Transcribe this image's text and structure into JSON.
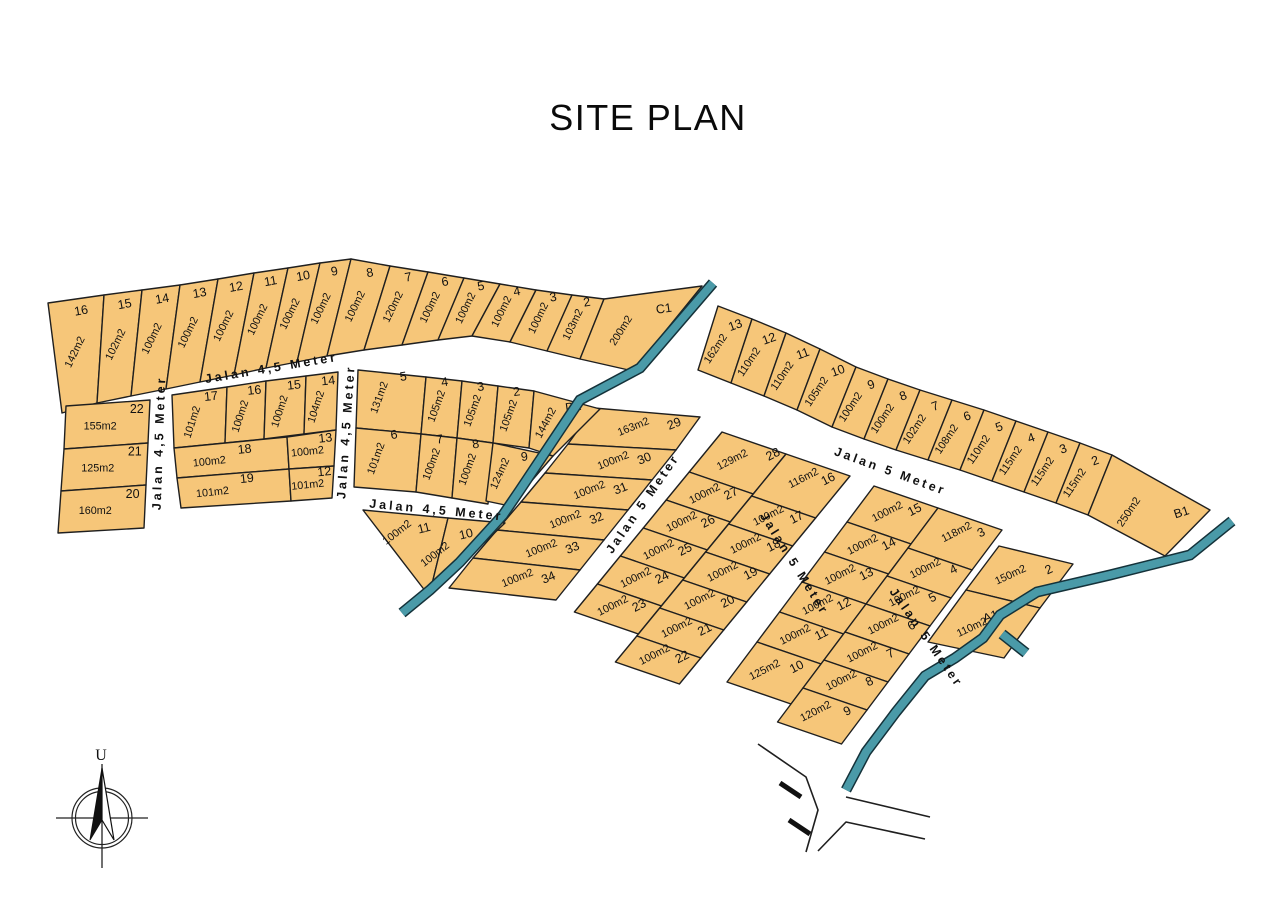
{
  "title": "SITE PLAN",
  "compass": {
    "north_label": "U"
  },
  "palette": {
    "lot_fill": "#F6C679",
    "lot_stroke": "#1F1F1F",
    "water": "#4A9AA8",
    "ink": "#111111"
  },
  "roads": {
    "top_45": "Jalan 4,5 Meter",
    "west_45": "Jalan 4,5 Meter",
    "mid_45": "Jalan 4,5 Meter",
    "lower_45": "Jalan 4,5 Meter",
    "d1_east_5": "Jalan 5 Meter",
    "mid_5": "Jalan 5 Meter",
    "northeast_5": "Jalan 5 Meter",
    "southeast_5": "Jalan 5 Meter"
  },
  "blocks": {
    "strip_top": {
      "lots": [
        {
          "no": "16",
          "size": "142m2"
        },
        {
          "no": "15",
          "size": "102m2"
        },
        {
          "no": "14",
          "size": "100m2"
        },
        {
          "no": "13",
          "size": "100m2"
        },
        {
          "no": "12",
          "size": "100m2"
        },
        {
          "no": "11",
          "size": "100m2"
        },
        {
          "no": "10",
          "size": "100m2"
        },
        {
          "no": "9",
          "size": "100m2"
        },
        {
          "no": "8",
          "size": "100m2"
        },
        {
          "no": "7",
          "size": "120m2"
        },
        {
          "no": "6",
          "size": "100m2"
        },
        {
          "no": "5",
          "size": "100m2"
        },
        {
          "no": "4",
          "size": "100m2"
        },
        {
          "no": "3",
          "size": "100m2"
        },
        {
          "no": "2",
          "size": "103m2"
        },
        {
          "no": "C1",
          "size": "200m2"
        }
      ]
    },
    "strip_right": {
      "lots": [
        {
          "no": "13",
          "size": "162m2"
        },
        {
          "no": "12",
          "size": "110m2"
        },
        {
          "no": "11",
          "size": "110m2"
        },
        {
          "no": "10",
          "size": "105m2"
        },
        {
          "no": "9",
          "size": "100m2"
        },
        {
          "no": "8",
          "size": "100m2"
        },
        {
          "no": "7",
          "size": "102m2"
        },
        {
          "no": "6",
          "size": "108m2"
        },
        {
          "no": "5",
          "size": "110m2"
        },
        {
          "no": "4",
          "size": "115m2"
        },
        {
          "no": "3",
          "size": "115m2"
        },
        {
          "no": "2",
          "size": "115m2"
        },
        {
          "no": "B1",
          "size": "250m2"
        }
      ]
    },
    "block_left": {
      "lots": [
        {
          "no": "22",
          "size": "155m2"
        },
        {
          "no": "21",
          "size": "125m2"
        },
        {
          "no": "20",
          "size": "160m2"
        }
      ]
    },
    "block_midwest": {
      "lots": [
        {
          "no": "17",
          "size": "101m2"
        },
        {
          "no": "16",
          "size": "100m2"
        },
        {
          "no": "15",
          "size": "100m2"
        },
        {
          "no": "14",
          "size": "104m2"
        },
        {
          "no": "18",
          "size": "100m2"
        },
        {
          "no": "13",
          "size": "100m2"
        },
        {
          "no": "19",
          "size": "101m2"
        },
        {
          "no": "12",
          "size": "101m2"
        }
      ]
    },
    "block_d1": {
      "lots": [
        {
          "no": "5",
          "size": "131m2"
        },
        {
          "no": "4",
          "size": "105m2"
        },
        {
          "no": "3",
          "size": "105m2"
        },
        {
          "no": "2",
          "size": "105m2"
        },
        {
          "no": "D1",
          "size": "144m2"
        },
        {
          "no": "6",
          "size": "101m2"
        },
        {
          "no": "7",
          "size": "100m2"
        },
        {
          "no": "8",
          "size": "100m2"
        },
        {
          "no": "9",
          "size": "124m2"
        }
      ]
    },
    "tri": {
      "lots": [
        {
          "no": "11",
          "size": "100m2"
        },
        {
          "no": "10",
          "size": "100m2"
        }
      ]
    },
    "strip1": {
      "lots": [
        {
          "no": "29",
          "size": "163m2"
        },
        {
          "no": "30",
          "size": "100m2"
        },
        {
          "no": "31",
          "size": "100m2"
        },
        {
          "no": "32",
          "size": "100m2"
        },
        {
          "no": "33",
          "size": "100m2"
        },
        {
          "no": "34",
          "size": "100m2"
        }
      ]
    },
    "block2": {
      "col_left": [
        {
          "no": "28",
          "size": "129m2"
        },
        {
          "no": "27",
          "size": "100m2"
        },
        {
          "no": "26",
          "size": "100m2"
        },
        {
          "no": "25",
          "size": "100m2"
        },
        {
          "no": "24",
          "size": "100m2"
        },
        {
          "no": "23",
          "size": "100m2"
        }
      ],
      "col_right": [
        {
          "no": "16",
          "size": "116m2"
        },
        {
          "no": "17",
          "size": "100m2"
        },
        {
          "no": "18",
          "size": "100m2"
        },
        {
          "no": "19",
          "size": "100m2"
        },
        {
          "no": "20",
          "size": "100m2"
        },
        {
          "no": "21",
          "size": "100m2"
        },
        {
          "no": "22",
          "size": "100m2"
        }
      ]
    },
    "block3": {
      "col_left": [
        {
          "no": "15",
          "size": "100m2"
        },
        {
          "no": "14",
          "size": "100m2"
        },
        {
          "no": "13",
          "size": "100m2"
        },
        {
          "no": "12",
          "size": "100m2"
        },
        {
          "no": "11",
          "size": "100m2"
        },
        {
          "no": "10",
          "size": "125m2"
        }
      ],
      "col_right": [
        {
          "no": "3",
          "size": "118m2"
        },
        {
          "no": "4",
          "size": "100m2"
        },
        {
          "no": "5",
          "size": "100m2"
        },
        {
          "no": "6",
          "size": "100m2"
        },
        {
          "no": "7",
          "size": "100m2"
        },
        {
          "no": "8",
          "size": "100m2"
        },
        {
          "no": "9",
          "size": "120m2"
        }
      ]
    },
    "block_a1": {
      "lots": [
        {
          "no": "2",
          "size": "150m2"
        },
        {
          "no": "A1",
          "size": "110m2"
        }
      ]
    }
  }
}
